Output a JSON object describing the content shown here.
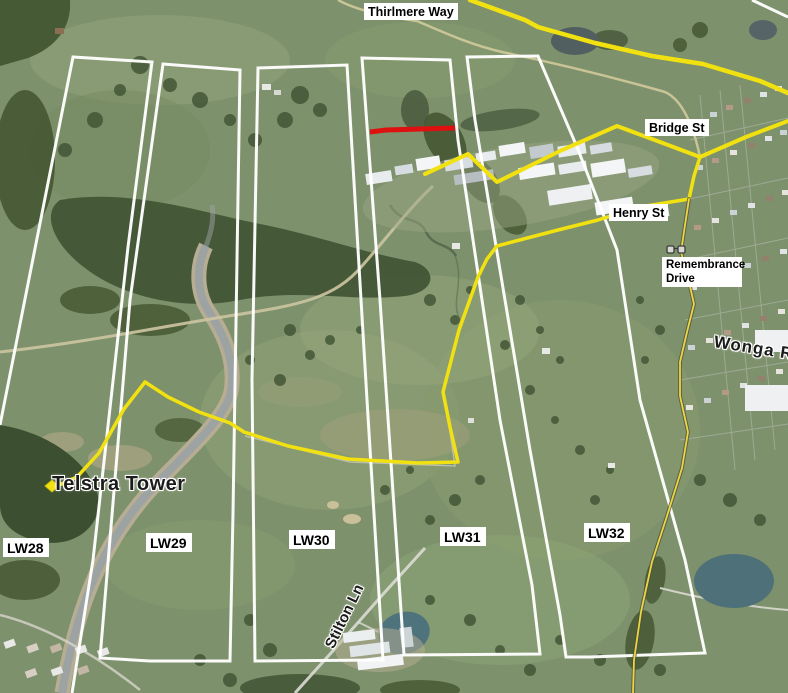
{
  "map": {
    "description": "Oblique aerial imagery with longwall mining panel outlines and highlighted road routes",
    "overlay_colors": {
      "panel_stroke": "#ffffff",
      "route_yellow": "#f2e111",
      "thin_route_yellow": "#ecd73d",
      "thin_route_casing": "#4d4d40",
      "red_segment": "#de1010"
    },
    "panels": [
      {
        "id": "LW28",
        "closed": false,
        "points": "0,425 73,57 152,62 128,247 93,560 72,693"
      },
      {
        "id": "LW29",
        "closed": true,
        "points": "163,64 240,70 233,513 230,661 150,661 100,658 130,300"
      },
      {
        "id": "LW30",
        "closed": true,
        "points": "258,68 347,65 367,400 383,660 255,661 252,380"
      },
      {
        "id": "LW31",
        "closed": true,
        "points": "362,58 450,60 458,140 500,420 532,585 540,654 404,655 380,300"
      },
      {
        "id": "LW32",
        "closed": true,
        "points": "467,57 538,56 577,147 617,250 640,400 685,560 705,653 590,657 566,657 560,615 530,450 475,120"
      },
      {
        "id": "boundary-segment",
        "closed": false,
        "points": "752,0 788,17"
      }
    ],
    "panel_labels": [
      {
        "text": "LW28"
      },
      {
        "text": "LW29"
      },
      {
        "text": "LW30"
      },
      {
        "text": "LW31"
      },
      {
        "text": "LW32"
      }
    ],
    "street_labels": {
      "thirlmere": {
        "text": "Thirlmere Way"
      },
      "bridge": {
        "text": "Bridge St"
      },
      "henry": {
        "text": "Henry St"
      },
      "remembrance": {
        "text": "Remembrance Drive"
      }
    },
    "imagery_labels": {
      "telstra": {
        "text": "Telstra Tower"
      },
      "stilton": {
        "text": "Stilton Ln"
      },
      "wonga": {
        "text": "Wonga R"
      }
    },
    "routes": [
      {
        "name": "northern-route",
        "width": 4.5,
        "points": "470,0 481,4 525,20 538,27 595,43 652,56 703,64 760,81 788,93"
      },
      {
        "name": "bridge-st-route",
        "width": 4,
        "points": "425,174 468,154 497,182 560,151 617,126 660,142 700,157 746,137 788,121"
      },
      {
        "name": "henry-st-telstra-route",
        "width": 3.5,
        "points": "700,157 694,176 689,199 640,207 598,220 558,230 497,246 487,259 478,277 459,330 443,392 450,427 458,462 418,463 348,459 288,446 244,432 230,423 199,412 168,397 145,382 124,409 99,453 77,477 57,486"
      },
      {
        "name": "remembrance-drive-road",
        "width": 1.8,
        "casing": true,
        "points": "689,199 685,225 681,252 689,282 694,304 687,332 680,362 680,396 688,432 682,468 667,516 652,562 641,612 634,660 633,693"
      }
    ],
    "red_segment": {
      "points": "370,132 386,130 455,128",
      "width": 5
    },
    "route_marker": {
      "points": "45,486 52,480 59,486 52,492"
    },
    "photo_icon": {
      "x": 676,
      "y": 250
    }
  }
}
